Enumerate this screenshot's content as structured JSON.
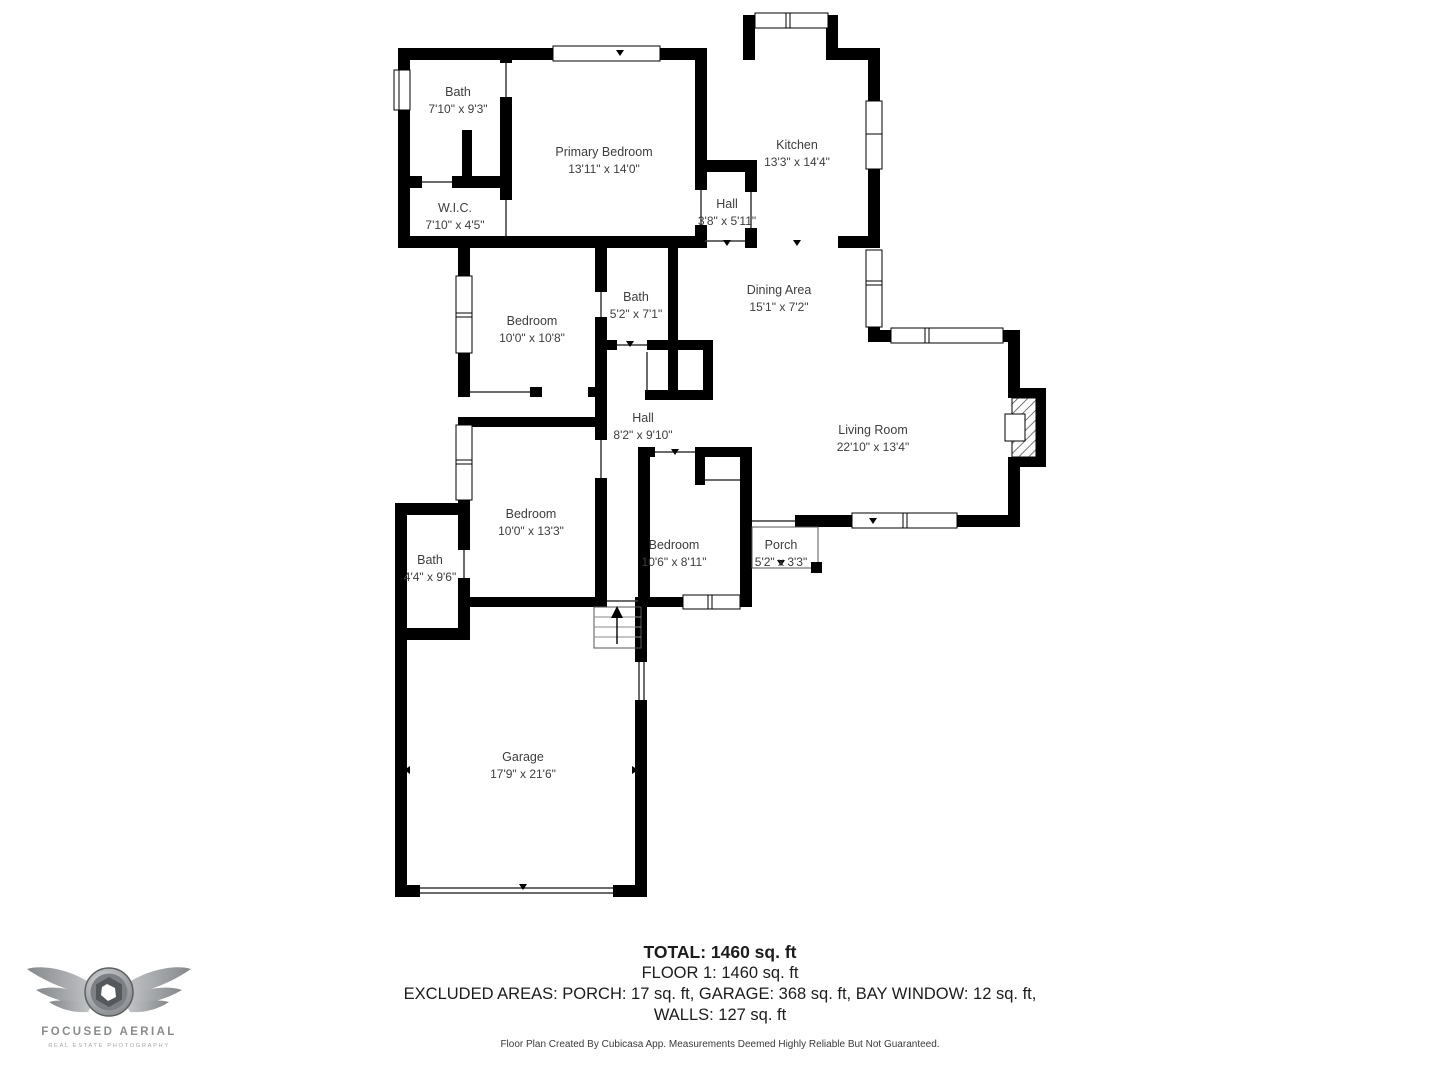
{
  "colors": {
    "wall": "#000000",
    "label": "#3d3d3d",
    "summary": "#1c1c1c",
    "logo": "#8b8e91"
  },
  "rooms": [
    {
      "name": "Bath",
      "dims": "7'10\" x 9'3\""
    },
    {
      "name": "Primary Bedroom",
      "dims": "13'11\" x 14'0\""
    },
    {
      "name": "Kitchen",
      "dims": "13'3\" x 14'4\""
    },
    {
      "name": "W.I.C.",
      "dims": "7'10\" x 4'5\""
    },
    {
      "name": "Hall",
      "dims": "3'8\" x 5'11\""
    },
    {
      "name": "Bedroom",
      "dims": "10'0\" x 10'8\""
    },
    {
      "name": "Bath",
      "dims": "5'2\" x 7'1\""
    },
    {
      "name": "Dining Area",
      "dims": "15'1\" x 7'2\""
    },
    {
      "name": "Hall",
      "dims": "8'2\" x 9'10\""
    },
    {
      "name": "Living Room",
      "dims": "22'10\" x 13'4\""
    },
    {
      "name": "Bedroom",
      "dims": "10'0\" x 13'3\""
    },
    {
      "name": "Bath",
      "dims": "4'4\" x 9'6\""
    },
    {
      "name": "Bedroom",
      "dims": "10'6\" x 8'11\""
    },
    {
      "name": "Porch",
      "dims": "5'2\" x 3'3\""
    },
    {
      "name": "Garage",
      "dims": "17'9\" x 21'6\""
    }
  ],
  "summary": {
    "total": "TOTAL: 1460 sq. ft",
    "floor": "FLOOR 1: 1460 sq. ft",
    "excluded": "EXCLUDED AREAS: PORCH: 17 sq. ft, GARAGE: 368 sq. ft, BAY WINDOW: 12 sq. ft,",
    "walls": "WALLS: 127 sq. ft",
    "disclaimer": "Floor Plan Created By Cubicasa App. Measurements Deemed Highly Reliable But Not Guaranteed."
  },
  "logo": {
    "title": "FOCUSED AERIAL",
    "subtitle": "REAL ESTATE PHOTOGRAPHY"
  }
}
